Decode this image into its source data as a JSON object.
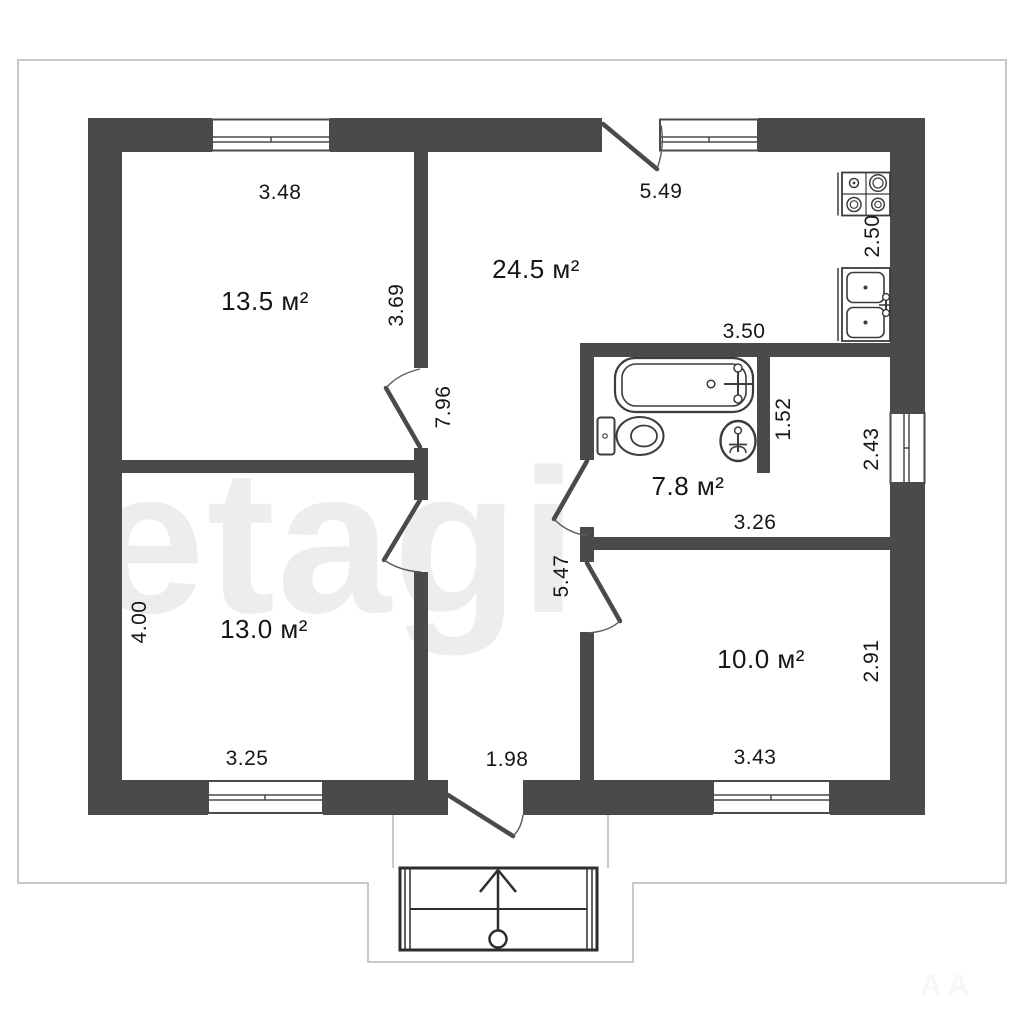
{
  "plan": {
    "watermark": "etagi",
    "corner_watermark": "A A",
    "room_labels": {
      "r135": "13.5 м²",
      "r245": "24.5 м²",
      "r78": "7.8 м²",
      "r130": "13.0 м²",
      "r100": "10.0 м²"
    },
    "dims": {
      "d348": "3.48",
      "d369": "3.69",
      "d796": "7.96",
      "d549": "5.49",
      "d250": "2.50",
      "d350": "3.50",
      "d152": "1.52",
      "d243": "2.43",
      "d326": "3.26",
      "d400": "4.00",
      "d547": "5.47",
      "d291": "2.91",
      "d325": "3.25",
      "d198": "1.98",
      "d343": "3.43"
    },
    "fixtures": [
      "stove",
      "kitchen-sink",
      "bathtub",
      "toilet",
      "washbasin",
      "entrance-porch"
    ],
    "colors": {
      "wall": "#4a4a4a",
      "building-outline": "#c9c9c9",
      "fixture-line": "#3c3c3c",
      "text": "#161616",
      "watermark": "#ededed",
      "background": "#ffffff"
    }
  }
}
